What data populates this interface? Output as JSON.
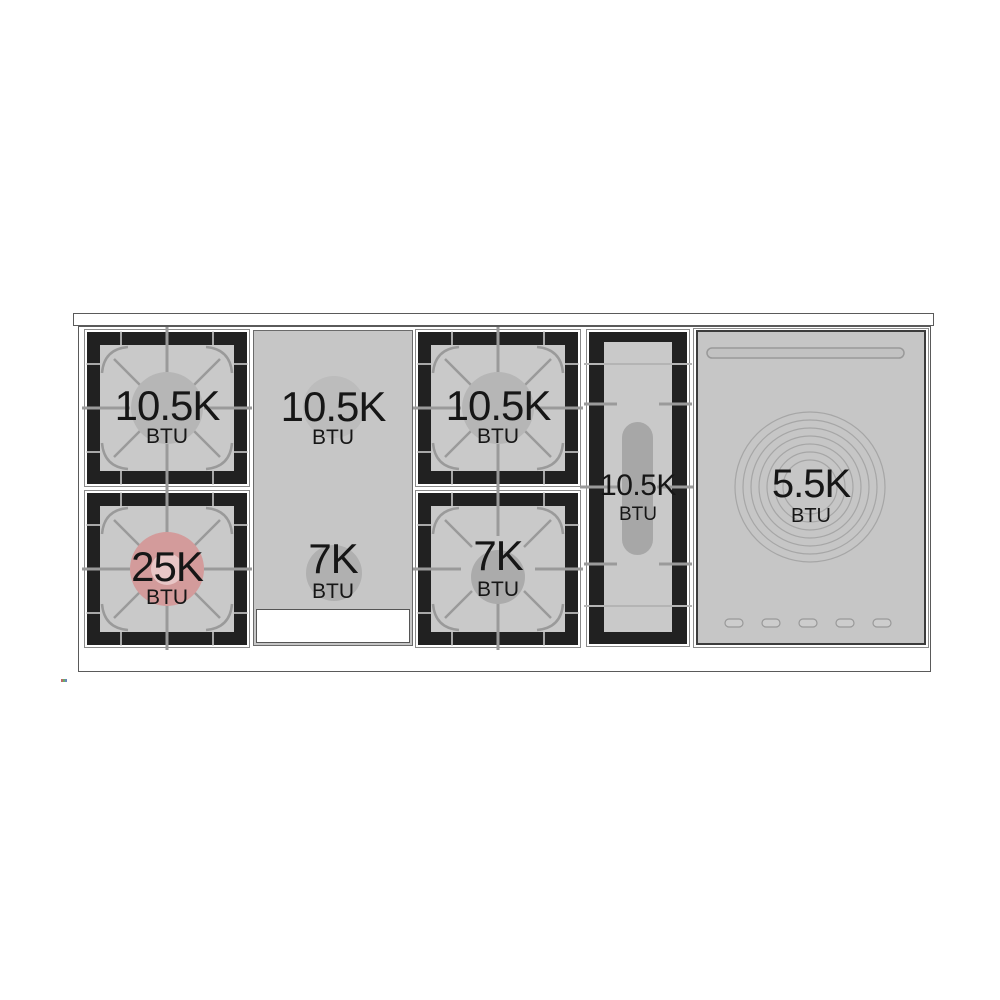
{
  "cooktop": {
    "sections": [
      {
        "id": "left-burner-pair",
        "burners": [
          {
            "power": "10.5K",
            "unit": "BTU"
          },
          {
            "power": "25K",
            "unit": "BTU"
          }
        ]
      },
      {
        "id": "griddle",
        "zones": [
          {
            "power": "10.5K",
            "unit": "BTU"
          },
          {
            "power": "7K",
            "unit": "BTU"
          }
        ]
      },
      {
        "id": "center-burner-pair",
        "burners": [
          {
            "power": "10.5K",
            "unit": "BTU"
          },
          {
            "power": "7K",
            "unit": "BTU"
          }
        ]
      },
      {
        "id": "oval-burner",
        "power": "10.5K",
        "unit": "BTU"
      },
      {
        "id": "french-top",
        "power": "5.5K",
        "unit": "BTU"
      }
    ],
    "colors": {
      "surface_gray": "#c9c9c9",
      "grate_frame": "#212121",
      "grate_lines": "#9a9a9a",
      "burner_disc": "#b6b6b6",
      "highlight_burner": "#d39b9b",
      "highlight_burner_inner": "#e8c6c6"
    }
  }
}
